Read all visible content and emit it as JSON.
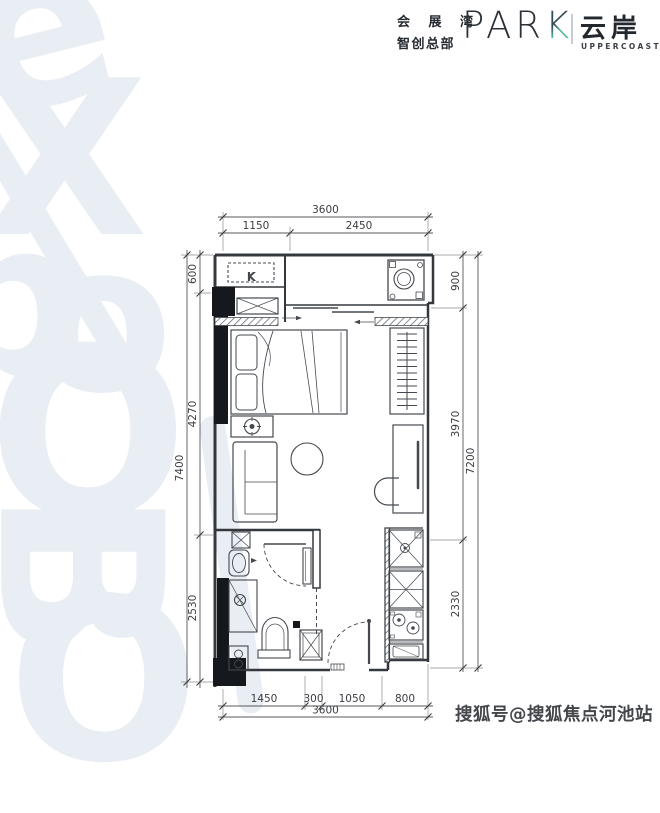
{
  "header": {
    "cn_line1": "会 展 湾",
    "cn_line2": "智创总部",
    "brand_par": "PAR",
    "brand_k": "K",
    "sub_cn": "云岸",
    "sub_en": "UPPERCOAST"
  },
  "watermark": {
    "background_letters": [
      "e",
      "X",
      "p",
      "o",
      "O",
      "B",
      "O"
    ],
    "bottom_right": "搜狐号@搜狐焦点河池站"
  },
  "plan": {
    "ac_label": "K",
    "dimensions": {
      "top": {
        "total": "3600",
        "segments": [
          "1150",
          "2450"
        ]
      },
      "bottom": {
        "total": "3600",
        "segments": [
          "1450",
          "300",
          "1050",
          "800"
        ]
      },
      "left": {
        "total": "7400",
        "segments": [
          "600",
          "4270",
          "2530"
        ]
      },
      "right": {
        "total": "7200",
        "segments": [
          "900",
          "3970",
          "2330"
        ]
      }
    },
    "colors": {
      "line": "#3c4046",
      "column_fill": "#15181c",
      "watermark_blue": "#e9edf4",
      "accent_teal": "#52b9a8"
    }
  }
}
